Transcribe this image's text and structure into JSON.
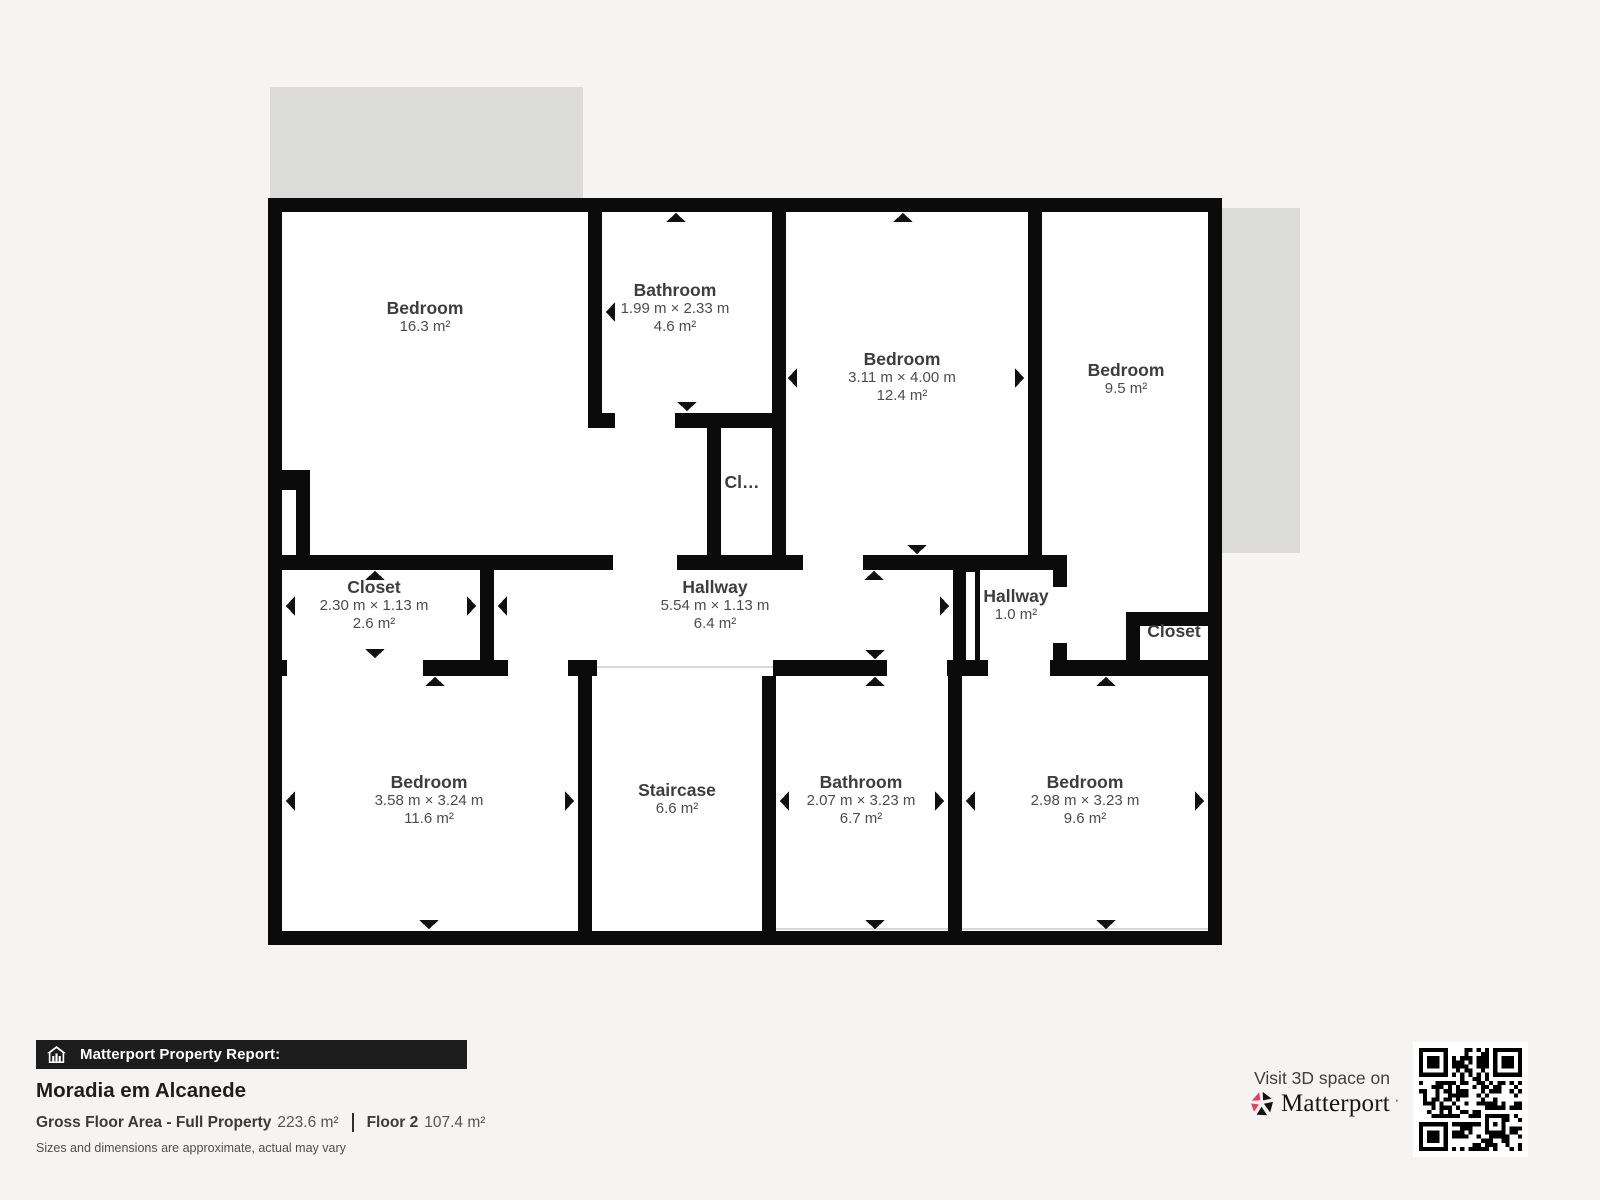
{
  "floorplan": {
    "rooms": [
      {
        "name": "Bedroom",
        "dims": "",
        "area": "16.3 m²"
      },
      {
        "name": "Bathroom",
        "dims": "1.99 m × 2.33 m",
        "area": "4.6 m²"
      },
      {
        "name": "Bedroom",
        "dims": "3.11 m × 4.00 m",
        "area": "12.4 m²"
      },
      {
        "name": "Bedroom",
        "dims": "",
        "area": "9.5 m²"
      },
      {
        "name": "Cl…",
        "dims": "",
        "area": ""
      },
      {
        "name": "Closet",
        "dims": "2.30 m × 1.13 m",
        "area": "2.6 m²"
      },
      {
        "name": "Hallway",
        "dims": "5.54 m × 1.13 m",
        "area": "6.4 m²"
      },
      {
        "name": "Hallway",
        "dims": "",
        "area": "1.0 m²"
      },
      {
        "name": "Closet",
        "dims": "",
        "area": ""
      },
      {
        "name": "Bedroom",
        "dims": "3.58 m × 3.24 m",
        "area": "11.6 m²"
      },
      {
        "name": "Staircase",
        "dims": "",
        "area": "6.6 m²"
      },
      {
        "name": "Bathroom",
        "dims": "2.07 m × 3.23 m",
        "area": "6.7 m²"
      },
      {
        "name": "Bedroom",
        "dims": "2.98 m × 3.23 m",
        "area": "9.6 m²"
      }
    ]
  },
  "report": {
    "bar_title": "Matterport Property Report:",
    "property_name": "Moradia em Alcanede",
    "gross_label": "Gross Floor Area - Full Property",
    "gross_value": "223.6 m²",
    "floor_label": "Floor 2",
    "floor_value": "107.4 m²",
    "disclaimer": "Sizes and dimensions are approximate, actual may vary"
  },
  "promo": {
    "visit_text": "Visit 3D space on",
    "brand": "Matterport",
    "brand_mark": "'"
  },
  "icons": {
    "report_icon": "house-chart-icon",
    "brand_icon": "matterport-pinwheel-icon",
    "qr": "qr-code"
  },
  "colors": {
    "wall": "#0b0b0b",
    "room_fill": "#ffffff",
    "background": "#f5f4f2",
    "shadow_gray": "#dbdbda",
    "brand_pink": "#f43a5a",
    "report_bar_bg": "#1d1d1d"
  }
}
